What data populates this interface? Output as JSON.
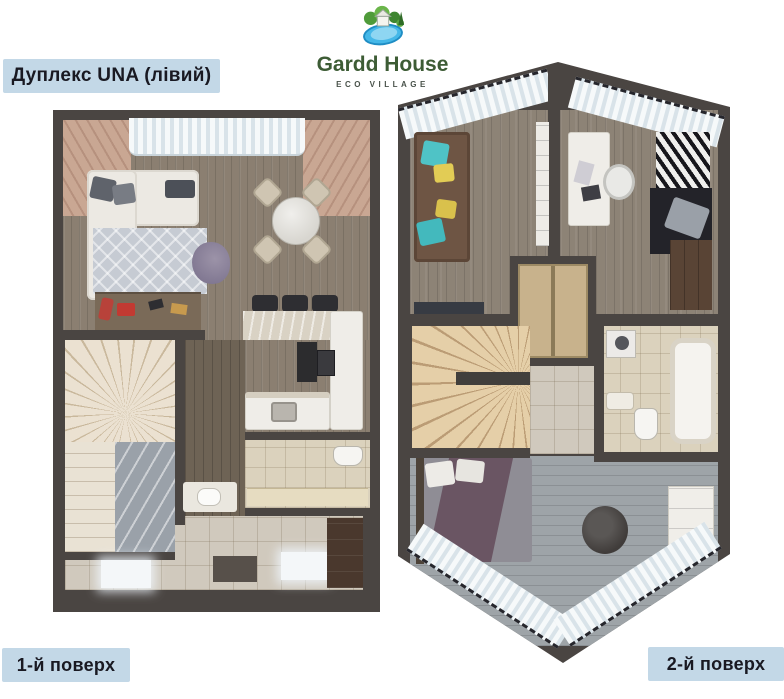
{
  "title_badge": {
    "label": "Дуплекс UNA (лівий)"
  },
  "brand": {
    "name": "Gardd House",
    "tagline": "ECO VILLAGE"
  },
  "floors": {
    "first": {
      "label": "1-й поверх"
    },
    "second": {
      "label": "2-й поверх"
    }
  },
  "colors": {
    "badge-bg": "#c3d8e7",
    "badge-text": "#191922",
    "brand-green": "#3d5c35",
    "brand-sub": "#49524a",
    "wall": "#4a4542",
    "wood-floor-1": "#8b7f71",
    "wood-floor-2": "#8d8376",
    "hall-wood": "#6e6355",
    "marble-light": "#d0c9bd",
    "stairs": "#e9e0d0",
    "curtain": "#eef3f6"
  }
}
